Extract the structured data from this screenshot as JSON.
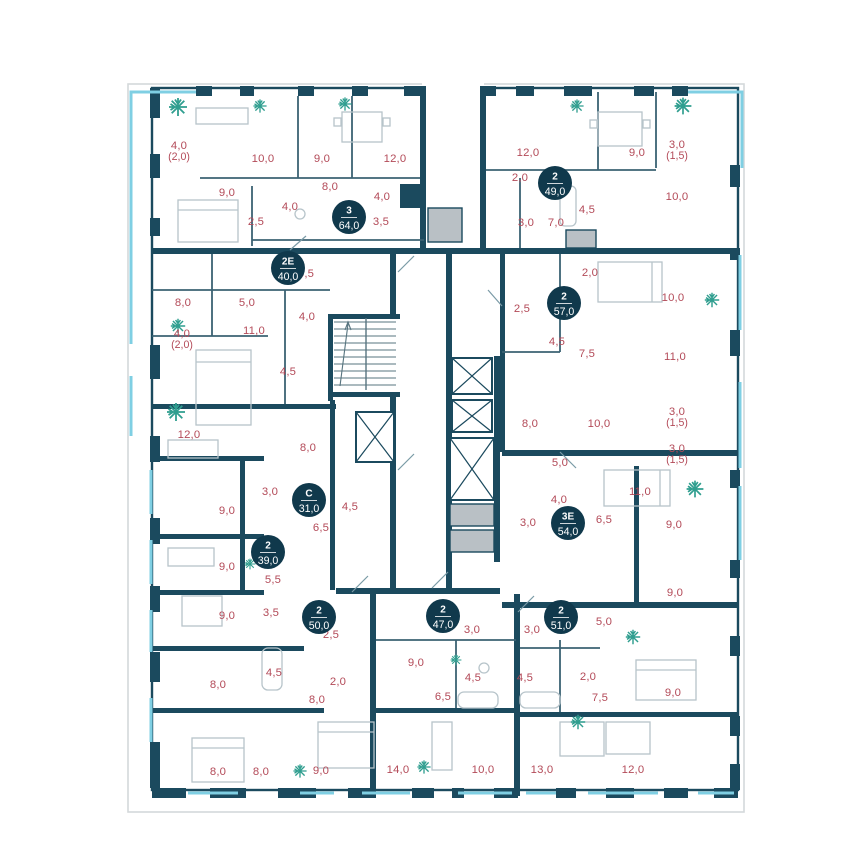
{
  "colors": {
    "wall": "#1b4a5e",
    "partition": "#3b6273",
    "room_label": "#b34a58",
    "badge_bg": "#10394c",
    "badge_text": "#ffffff",
    "glazing": "#7fcfe3",
    "plant": "#2f9e8f",
    "shaft_fill": "#b9c0c5",
    "furniture": "#b7c4ca",
    "rail": "#d4d8da"
  },
  "units": [
    {
      "type": "3",
      "area": "64,0",
      "x": 349,
      "y": 217
    },
    {
      "type": "2Е",
      "area": "40,0",
      "x": 288,
      "y": 268
    },
    {
      "type": "2",
      "area": "49,0",
      "x": 555,
      "y": 183
    },
    {
      "type": "2",
      "area": "57,0",
      "x": 564,
      "y": 303
    },
    {
      "type": "С",
      "area": "31,0",
      "x": 309,
      "y": 500
    },
    {
      "type": "2",
      "area": "39,0",
      "x": 268,
      "y": 552
    },
    {
      "type": "2",
      "area": "50,0",
      "x": 319,
      "y": 617
    },
    {
      "type": "2",
      "area": "47,0",
      "x": 443,
      "y": 616
    },
    {
      "type": "2",
      "area": "51,0",
      "x": 561,
      "y": 617
    },
    {
      "type": "3Е",
      "area": "54,0",
      "x": 568,
      "y": 523
    }
  ],
  "rooms": [
    {
      "label": "4,0",
      "sub": "(2,0)",
      "x": 179,
      "y": 145
    },
    {
      "label": "10,0",
      "x": 263,
      "y": 158
    },
    {
      "label": "9,0",
      "x": 322,
      "y": 158
    },
    {
      "label": "12,0",
      "x": 395,
      "y": 158
    },
    {
      "label": "8,0",
      "x": 330,
      "y": 186
    },
    {
      "label": "9,0",
      "x": 227,
      "y": 192
    },
    {
      "label": "4,0",
      "x": 382,
      "y": 196
    },
    {
      "label": "4,0",
      "x": 290,
      "y": 206
    },
    {
      "label": "2,5",
      "x": 256,
      "y": 221
    },
    {
      "label": "3,5",
      "x": 381,
      "y": 221
    },
    {
      "label": "5,5",
      "x": 306,
      "y": 273
    },
    {
      "label": "8,0",
      "x": 183,
      "y": 302
    },
    {
      "label": "5,0",
      "x": 247,
      "y": 302
    },
    {
      "label": "4,0",
      "x": 307,
      "y": 316
    },
    {
      "label": "11,0",
      "x": 254,
      "y": 330
    },
    {
      "label": "4,0",
      "sub": "(2,0)",
      "x": 182,
      "y": 333
    },
    {
      "label": "4,5",
      "x": 288,
      "y": 371
    },
    {
      "label": "12,0",
      "x": 189,
      "y": 434
    },
    {
      "label": "8,0",
      "x": 308,
      "y": 447
    },
    {
      "label": "3,0",
      "x": 270,
      "y": 491
    },
    {
      "label": "4,5",
      "x": 350,
      "y": 506
    },
    {
      "label": "9,0",
      "x": 227,
      "y": 510
    },
    {
      "label": "6,5",
      "x": 321,
      "y": 527
    },
    {
      "label": "9,0",
      "x": 227,
      "y": 566
    },
    {
      "label": "5,5",
      "x": 273,
      "y": 579
    },
    {
      "label": "3,5",
      "x": 271,
      "y": 612
    },
    {
      "label": "9,0",
      "x": 227,
      "y": 615
    },
    {
      "label": "2,5",
      "x": 331,
      "y": 634
    },
    {
      "label": "4,5",
      "x": 274,
      "y": 672
    },
    {
      "label": "2,0",
      "x": 338,
      "y": 681
    },
    {
      "label": "8,0",
      "x": 218,
      "y": 684
    },
    {
      "label": "8,0",
      "x": 317,
      "y": 699
    },
    {
      "label": "8,0",
      "x": 218,
      "y": 771
    },
    {
      "label": "8,0",
      "x": 261,
      "y": 771
    },
    {
      "label": "9,0",
      "x": 321,
      "y": 770
    },
    {
      "label": "12,0",
      "x": 528,
      "y": 152
    },
    {
      "label": "9,0",
      "x": 637,
      "y": 152
    },
    {
      "label": "3,0",
      "sub": "(1,5)",
      "x": 677,
      "y": 144
    },
    {
      "label": "2,0",
      "x": 520,
      "y": 177
    },
    {
      "label": "4,5",
      "x": 587,
      "y": 209
    },
    {
      "label": "10,0",
      "x": 677,
      "y": 196
    },
    {
      "label": "3,0",
      "x": 526,
      "y": 222
    },
    {
      "label": "7,0",
      "x": 556,
      "y": 222
    },
    {
      "label": "2,0",
      "x": 590,
      "y": 272
    },
    {
      "label": "2,5",
      "x": 522,
      "y": 308
    },
    {
      "label": "10,0",
      "x": 673,
      "y": 297
    },
    {
      "label": "4,5",
      "x": 557,
      "y": 341
    },
    {
      "label": "7,5",
      "x": 587,
      "y": 353
    },
    {
      "label": "11,0",
      "x": 675,
      "y": 356
    },
    {
      "label": "8,0",
      "x": 530,
      "y": 423
    },
    {
      "label": "10,0",
      "x": 599,
      "y": 423
    },
    {
      "label": "3,0",
      "sub": "(1,5)",
      "x": 677,
      "y": 411
    },
    {
      "label": "3,0",
      "sub": "(1,5)",
      "x": 677,
      "y": 448
    },
    {
      "label": "5,0",
      "x": 560,
      "y": 462
    },
    {
      "label": "4,0",
      "x": 559,
      "y": 499
    },
    {
      "label": "11,0",
      "x": 640,
      "y": 491
    },
    {
      "label": "3,0",
      "x": 528,
      "y": 522
    },
    {
      "label": "6,5",
      "x": 604,
      "y": 519
    },
    {
      "label": "9,0",
      "x": 674,
      "y": 524
    },
    {
      "label": "9,0",
      "x": 675,
      "y": 592
    },
    {
      "label": "3,0",
      "x": 472,
      "y": 629
    },
    {
      "label": "3,0",
      "x": 532,
      "y": 629
    },
    {
      "label": "9,0",
      "x": 416,
      "y": 662
    },
    {
      "label": "4,5",
      "x": 473,
      "y": 677
    },
    {
      "label": "4,5",
      "x": 525,
      "y": 677
    },
    {
      "label": "6,5",
      "x": 443,
      "y": 696
    },
    {
      "label": "14,0",
      "x": 398,
      "y": 769
    },
    {
      "label": "10,0",
      "x": 483,
      "y": 769
    },
    {
      "label": "5,0",
      "x": 604,
      "y": 621
    },
    {
      "label": "2,0",
      "x": 588,
      "y": 676
    },
    {
      "label": "7,5",
      "x": 600,
      "y": 697
    },
    {
      "label": "9,0",
      "x": 673,
      "y": 692
    },
    {
      "label": "13,0",
      "x": 542,
      "y": 769
    },
    {
      "label": "12,0",
      "x": 633,
      "y": 769
    }
  ],
  "plants": [
    {
      "x": 178,
      "y": 107,
      "s": 1.5
    },
    {
      "x": 260,
      "y": 106,
      "s": 1.1
    },
    {
      "x": 345,
      "y": 104,
      "s": 1.1
    },
    {
      "x": 577,
      "y": 106,
      "s": 1.1
    },
    {
      "x": 683,
      "y": 106,
      "s": 1.4
    },
    {
      "x": 178,
      "y": 326,
      "s": 1.2
    },
    {
      "x": 176,
      "y": 412,
      "s": 1.5
    },
    {
      "x": 712,
      "y": 300,
      "s": 1.2
    },
    {
      "x": 695,
      "y": 489,
      "s": 1.4
    },
    {
      "x": 633,
      "y": 637,
      "s": 1.2
    },
    {
      "x": 578,
      "y": 722,
      "s": 1.2
    },
    {
      "x": 300,
      "y": 771,
      "s": 1.1
    },
    {
      "x": 424,
      "y": 767,
      "s": 1.1
    },
    {
      "x": 456,
      "y": 660,
      "s": 0.9
    },
    {
      "x": 250,
      "y": 564,
      "s": 0.9
    }
  ]
}
